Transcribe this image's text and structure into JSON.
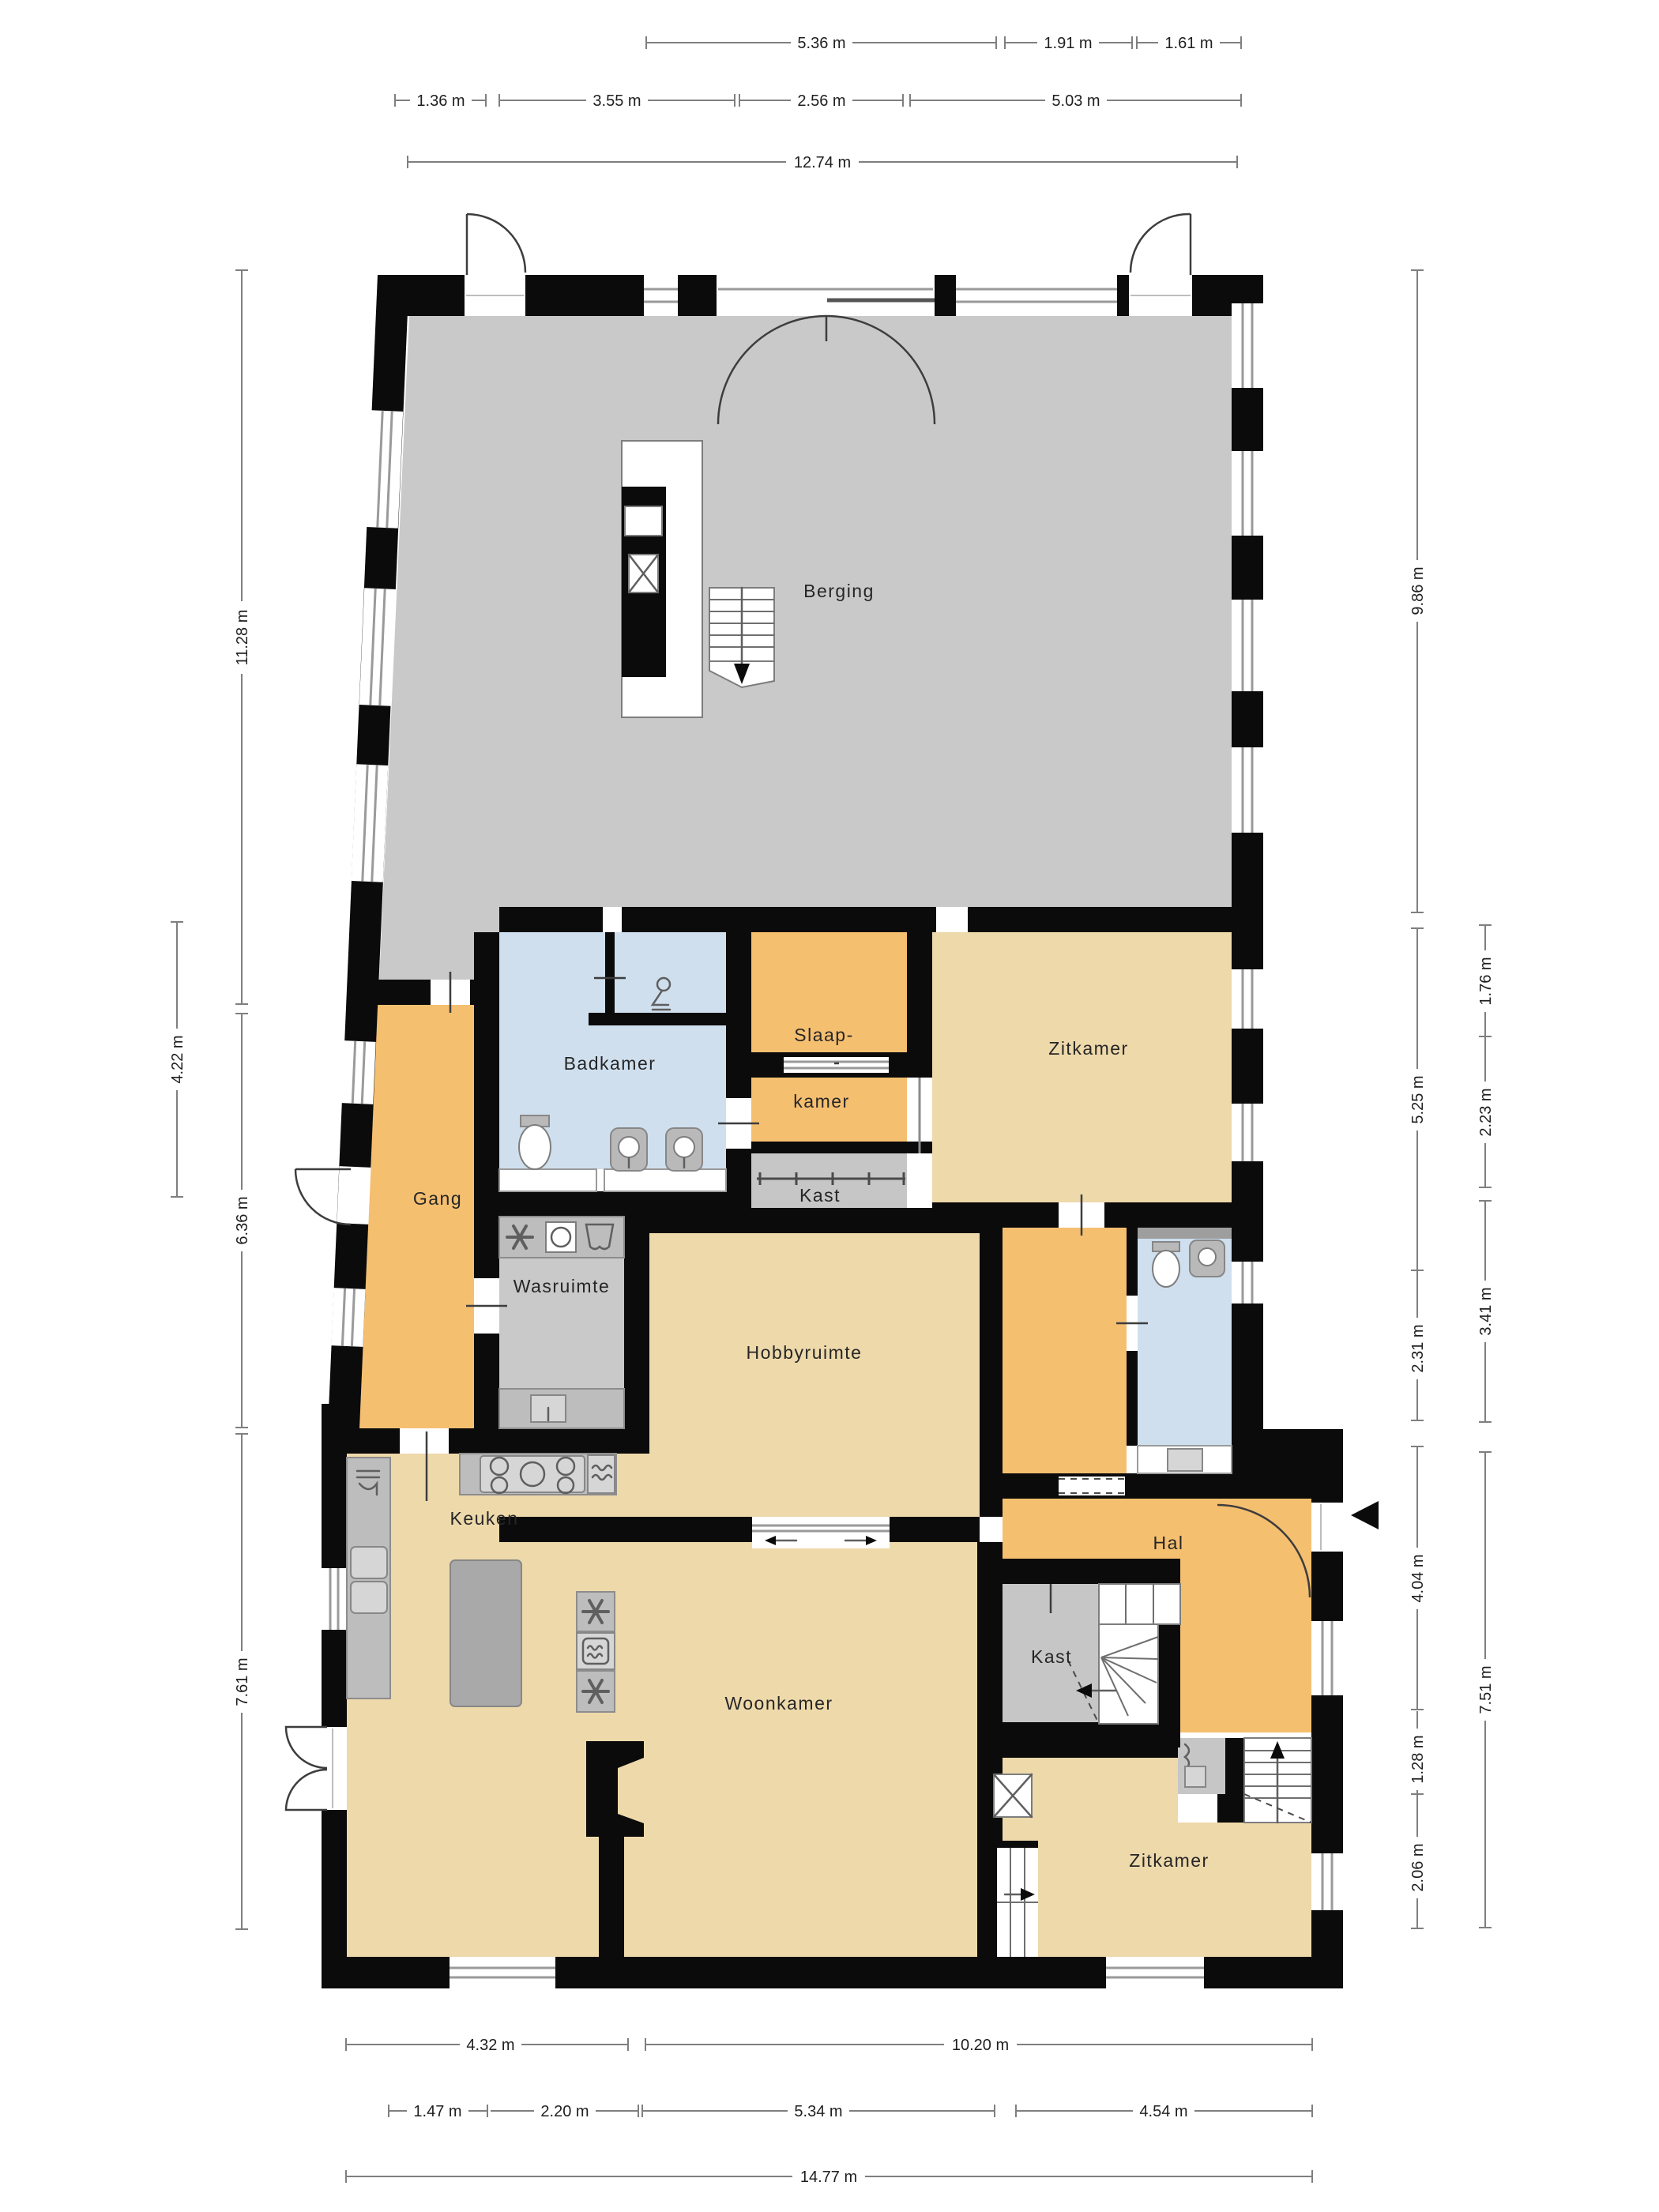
{
  "rooms": {
    "berging": "Berging",
    "badkamer": "Badkamer",
    "slaapkamer_line1": "Slaap-",
    "slaapkamer_line2": "kamer",
    "zitkamer_boven": "Zitkamer",
    "kast_boven": "Kast",
    "gang": "Gang",
    "wasruimte": "Wasruimte",
    "hobbyruimte": "Hobbyruimte",
    "keuken": "Keuken",
    "hal": "Hal",
    "kast_onder": "Kast",
    "woonkamer": "Woonkamer",
    "zitkamer_onder": "Zitkamer"
  },
  "dims": {
    "top1": [
      "5.36 m",
      "1.91 m",
      "1.61 m"
    ],
    "top2": [
      "1.36 m",
      "3.55 m",
      "2.56 m",
      "5.03 m"
    ],
    "top3": [
      "12.74 m"
    ],
    "left_inner": [
      "11.28 m",
      "6.36 m",
      "7.61 m"
    ],
    "left_outer": [
      "4.22 m"
    ],
    "right_inner": [
      "9.86 m",
      "5.25 m",
      "2.31 m",
      "4.04 m",
      "1.28 m",
      "2.06 m"
    ],
    "right_outer": [
      "1.76 m",
      "2.23 m",
      "3.41 m",
      "7.51 m"
    ],
    "bottom1": [
      "4.32 m",
      "10.20 m"
    ],
    "bottom2": [
      "1.47 m",
      "2.20 m",
      "5.34 m",
      "4.54 m"
    ],
    "bottom3": [
      "14.77 m"
    ]
  },
  "colors": {
    "wall": "#0b0b0b",
    "storage_floor": "#c9c9c9",
    "living_floor": "#eed9ab",
    "hall_floor": "#f5bf70",
    "bath_floor": "#cfdfee",
    "utility_floor": "#c9c9c9",
    "closet_floor": "#c6c6c6",
    "dim_line": "#7f7f7f",
    "label_text": "#262626"
  },
  "icons": {
    "entrance_arrow": "left-pointing-triangle",
    "fan": "six-blade-fan",
    "washing_machine": "square-with-drum",
    "garment": "hanging-cloth",
    "oven": "rounded-square-heat-waves",
    "stove": "five-burner-hob",
    "shower_person": "stick-figure",
    "stairs_up_arrow": "arrow-up",
    "stairs_down_arrow": "arrow-down"
  }
}
